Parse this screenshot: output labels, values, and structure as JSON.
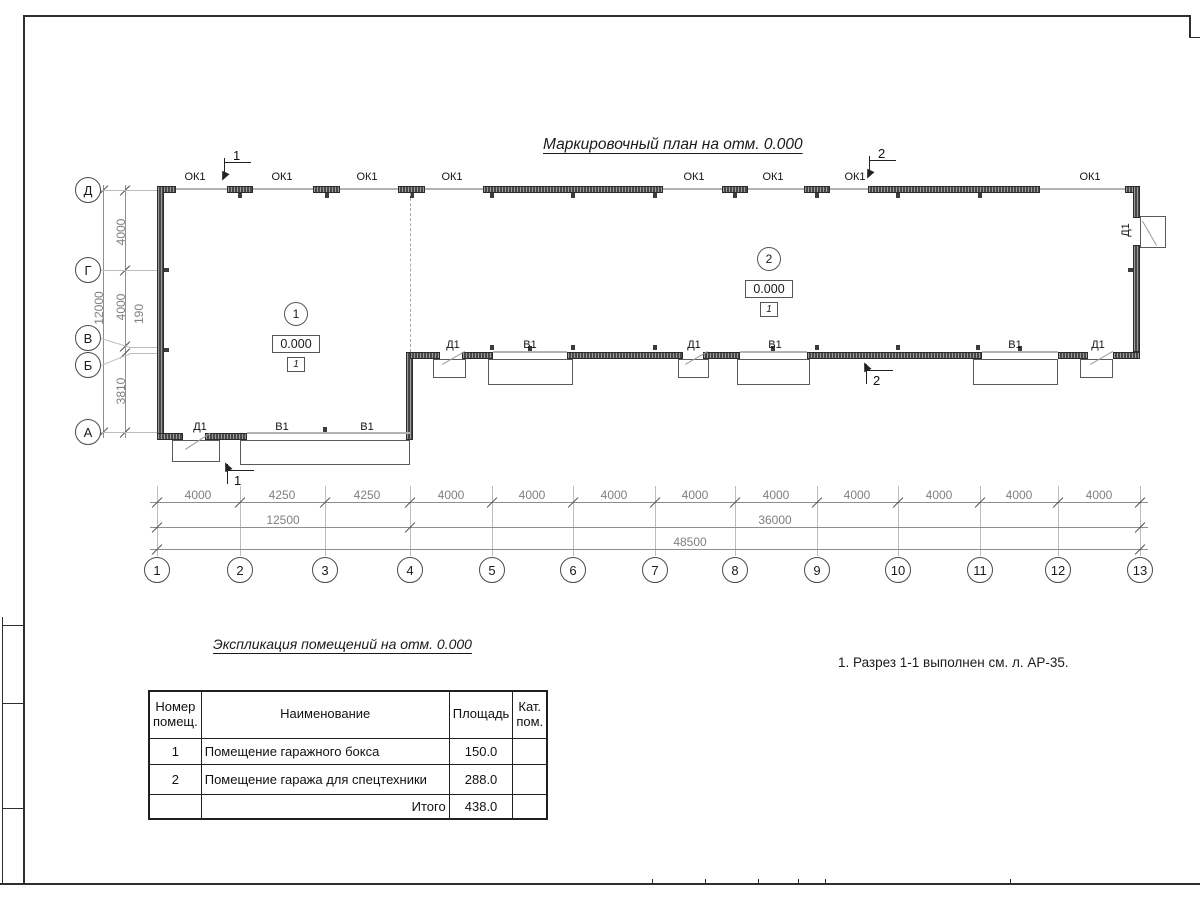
{
  "plan": {
    "title": "Маркировочный план на отм. 0.000",
    "opening_labels": {
      "window": "ОК1",
      "door": "Д1",
      "gate": "В1"
    },
    "rooms": [
      {
        "number": "1",
        "elevation": "0.000",
        "floor_type": "1"
      },
      {
        "number": "2",
        "elevation": "0.000",
        "floor_type": "1"
      }
    ],
    "axes": {
      "vertical": [
        "Д",
        "Г",
        "В",
        "Б",
        "А"
      ],
      "horizontal": [
        "1",
        "2",
        "3",
        "4",
        "5",
        "6",
        "7",
        "8",
        "9",
        "10",
        "11",
        "12",
        "13"
      ]
    },
    "dimensions": {
      "left": {
        "segments": [
          "4000",
          "4000",
          "190",
          "3810"
        ],
        "total": "12000"
      },
      "bottom": {
        "segments": [
          "4000",
          "4250",
          "4250",
          "4000",
          "4000",
          "4000",
          "4000",
          "4000",
          "4000",
          "4000",
          "4000",
          "4000"
        ],
        "subtotals": [
          "12500",
          "36000"
        ],
        "total": "48500"
      }
    },
    "sections": [
      {
        "label": "1"
      },
      {
        "label": "2"
      }
    ]
  },
  "note": "1. Разрез 1-1 выполнен см. л. АР-35.",
  "table": {
    "title": "Экспликация помещений на отм. 0.000",
    "headers": [
      "Номер помещ.",
      "Наименование",
      "Площадь",
      "Кат. пом."
    ],
    "rows": [
      {
        "num": "1",
        "name": "Помещение гаражного бокса",
        "area": "150.0",
        "cat": ""
      },
      {
        "num": "2",
        "name": "Помещение гаража для спецтехники",
        "area": "288.0",
        "cat": ""
      }
    ],
    "total_label": "Итого",
    "total_area": "438.0"
  }
}
